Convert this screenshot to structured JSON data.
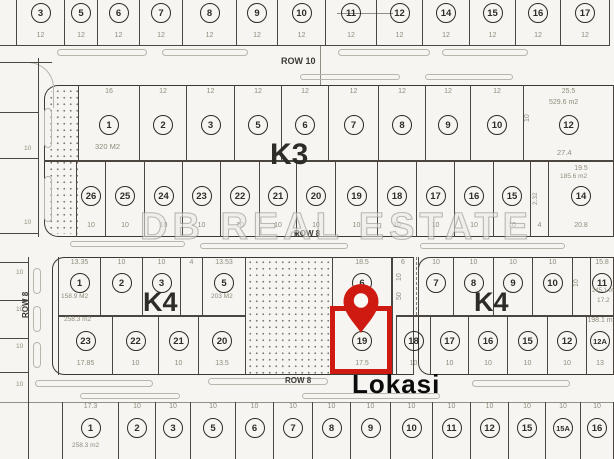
{
  "title": "site plan map",
  "location_label": "Lokasi",
  "watermark_text": "DB REAL ESTATE",
  "colors": {
    "paper": "#f6f5f1",
    "line": "#4b4740",
    "dimension": "#8f8b7c",
    "marker_red": "#cf1a12"
  },
  "strips": [
    {
      "name": "top-row-lots",
      "y": 0,
      "h": 46,
      "c": 3,
      "bY": 32,
      "cells": [
        {
          "x1": 16,
          "x2": 64,
          "n": "3",
          "b": "12"
        },
        {
          "x1": 64,
          "x2": 97,
          "n": "5",
          "b": "12"
        },
        {
          "x1": 97,
          "x2": 139,
          "n": "6",
          "b": "12"
        },
        {
          "x1": 139,
          "x2": 182,
          "n": "7",
          "b": "12"
        },
        {
          "x1": 182,
          "x2": 236,
          "n": "8",
          "b": "12"
        },
        {
          "x1": 236,
          "x2": 277,
          "n": "9",
          "b": "12"
        },
        {
          "x1": 277,
          "x2": 325,
          "n": "10",
          "b": "12"
        },
        {
          "x1": 325,
          "x2": 376,
          "n": "11",
          "b": "12"
        },
        {
          "x1": 376,
          "x2": 422,
          "n": "12",
          "b": "12"
        },
        {
          "x1": 422,
          "x2": 469,
          "n": "14",
          "b": "12"
        },
        {
          "x1": 469,
          "x2": 515,
          "n": "15",
          "b": "12"
        },
        {
          "x1": 515,
          "x2": 560,
          "n": "16",
          "b": "12"
        },
        {
          "x1": 560,
          "x2": 610,
          "n": "17",
          "b": "12"
        }
      ]
    },
    {
      "name": "k3-top-row",
      "y": 85,
      "h": 75,
      "c": 30,
      "tY": 3,
      "cells": [
        {
          "x1": 78,
          "x2": 139,
          "n": "1",
          "t": "16"
        },
        {
          "x1": 139,
          "x2": 186,
          "n": "2",
          "t": "12"
        },
        {
          "x1": 186,
          "x2": 234,
          "n": "3",
          "t": "12"
        },
        {
          "x1": 234,
          "x2": 281,
          "n": "5",
          "t": "12"
        },
        {
          "x1": 281,
          "x2": 328,
          "n": "6",
          "t": "12"
        },
        {
          "x1": 328,
          "x2": 378,
          "n": "7",
          "t": "12"
        },
        {
          "x1": 378,
          "x2": 425,
          "n": "8",
          "t": "12"
        },
        {
          "x1": 425,
          "x2": 470,
          "n": "9",
          "t": "12"
        },
        {
          "x1": 470,
          "x2": 523,
          "n": "10",
          "t": "12"
        },
        {
          "x1": 523,
          "x2": 614,
          "n": "12",
          "t": "25.5"
        }
      ]
    },
    {
      "name": "k3-bottom-row",
      "y": 162,
      "h": 75,
      "c": 24,
      "bY": 60,
      "tY": 3,
      "cells": [
        {
          "x1": 76,
          "x2": 105,
          "n": "26",
          "b": "10"
        },
        {
          "x1": 105,
          "x2": 144,
          "n": "25",
          "b": "10"
        },
        {
          "x1": 144,
          "x2": 182,
          "n": "24",
          "b": "10"
        },
        {
          "x1": 182,
          "x2": 220,
          "n": "23",
          "b": "10"
        },
        {
          "x1": 220,
          "x2": 259,
          "n": "22",
          "b": "10"
        },
        {
          "x1": 259,
          "x2": 296,
          "n": "21",
          "b": "10"
        },
        {
          "x1": 296,
          "x2": 335,
          "n": "20",
          "b": "10"
        },
        {
          "x1": 335,
          "x2": 377,
          "n": "19",
          "b": "10"
        },
        {
          "x1": 377,
          "x2": 416,
          "n": "18",
          "b": "10"
        },
        {
          "x1": 416,
          "x2": 454,
          "n": "17",
          "b": "10"
        },
        {
          "x1": 454,
          "x2": 493,
          "n": "16",
          "b": "10"
        },
        {
          "x1": 493,
          "x2": 530,
          "n": "15",
          "b": "10"
        },
        {
          "x1": 530,
          "x2": 548,
          "b": "4"
        },
        {
          "x1": 548,
          "x2": 614,
          "n": "14",
          "t": "19.5",
          "b": "20.8"
        }
      ]
    },
    {
      "name": "k4-left-top-row",
      "y": 257,
      "h": 58,
      "c": 16,
      "tY": 2,
      "cells": [
        {
          "x1": 58,
          "x2": 100,
          "n": "1",
          "t": "13.35"
        },
        {
          "x1": 100,
          "x2": 142,
          "n": "2",
          "t": "10"
        },
        {
          "x1": 142,
          "x2": 180,
          "n": "3",
          "t": "10"
        },
        {
          "x1": 180,
          "x2": 202,
          "t": "4"
        },
        {
          "x1": 202,
          "x2": 246,
          "n": "5",
          "t": "13.53"
        }
      ]
    },
    {
      "name": "k4-left-bottom-row",
      "y": 315,
      "h": 60,
      "c": 16,
      "bY": 45,
      "cells": [
        {
          "x1": 58,
          "x2": 112,
          "n": "23",
          "b": "17.85"
        },
        {
          "x1": 112,
          "x2": 158,
          "n": "22",
          "b": "10"
        },
        {
          "x1": 158,
          "x2": 198,
          "n": "21",
          "b": "10"
        },
        {
          "x1": 198,
          "x2": 246,
          "n": "20",
          "b": "13.5"
        }
      ]
    },
    {
      "name": "k4-lot6",
      "y": 257,
      "h": 58,
      "c": 16,
      "tY": 2,
      "cells": [
        {
          "x1": 332,
          "x2": 392,
          "n": "6",
          "t": "18.5"
        }
      ]
    },
    {
      "name": "k4-narrow-lot",
      "y": 257,
      "h": 118,
      "tY": 2,
      "cells": [
        {
          "x1": 392,
          "x2": 414,
          "t": "6"
        }
      ]
    },
    {
      "name": "k4-lot19-highlighted",
      "y": 315,
      "h": 60,
      "c": 16,
      "bY": 45,
      "cells": [
        {
          "x1": 332,
          "x2": 392,
          "n": "19",
          "b": "17.5"
        }
      ]
    },
    {
      "name": "k4-right-top-row",
      "y": 257,
      "h": 58,
      "c": 16,
      "tY": 2,
      "cells": [
        {
          "x1": 418,
          "x2": 453,
          "n": "7",
          "t": "10"
        },
        {
          "x1": 453,
          "x2": 493,
          "n": "8",
          "t": "10"
        },
        {
          "x1": 493,
          "x2": 532,
          "n": "9",
          "t": "10"
        },
        {
          "x1": 532,
          "x2": 572,
          "n": "10",
          "t": "10"
        },
        {
          "x1": 572,
          "x2": 590
        },
        {
          "x1": 590,
          "x2": 614,
          "n": "11",
          "t": "15.8"
        }
      ]
    },
    {
      "name": "k4-right-bottom-row",
      "y": 315,
      "h": 60,
      "c": 16,
      "bY": 45,
      "tY": 2,
      "cells": [
        {
          "x1": 396,
          "x2": 430,
          "n": "18",
          "b": "10"
        },
        {
          "x1": 430,
          "x2": 468,
          "n": "17",
          "b": "10"
        },
        {
          "x1": 468,
          "x2": 507,
          "n": "16",
          "b": "10"
        },
        {
          "x1": 507,
          "x2": 547,
          "n": "15",
          "b": "10"
        },
        {
          "x1": 547,
          "x2": 586,
          "n": "12",
          "b": "10"
        },
        {
          "x1": 586,
          "x2": 614,
          "n": "12A",
          "t": "198.1 m",
          "b": "13"
        }
      ]
    },
    {
      "name": "bottom-row-lots",
      "y": 402,
      "h": 57,
      "c": 16,
      "tY": 1,
      "cells": [
        {
          "x1": 28,
          "x2": 62
        },
        {
          "x1": 62,
          "x2": 118,
          "n": "1",
          "t": "17.3"
        },
        {
          "x1": 118,
          "x2": 155,
          "n": "2",
          "t": "10"
        },
        {
          "x1": 155,
          "x2": 190,
          "n": "3",
          "t": "10"
        },
        {
          "x1": 190,
          "x2": 235,
          "n": "5",
          "t": "10"
        },
        {
          "x1": 235,
          "x2": 273,
          "n": "6",
          "t": "10"
        },
        {
          "x1": 273,
          "x2": 312,
          "n": "7",
          "t": "10"
        },
        {
          "x1": 312,
          "x2": 350,
          "n": "8",
          "t": "10"
        },
        {
          "x1": 350,
          "x2": 390,
          "n": "9",
          "t": "10"
        },
        {
          "x1": 390,
          "x2": 432,
          "n": "10",
          "t": "10"
        },
        {
          "x1": 432,
          "x2": 470,
          "n": "11",
          "t": "10"
        },
        {
          "x1": 470,
          "x2": 508,
          "n": "12",
          "t": "10"
        },
        {
          "x1": 508,
          "x2": 545,
          "n": "15",
          "t": "10"
        },
        {
          "x1": 545,
          "x2": 580,
          "n": "15A",
          "t": "10"
        },
        {
          "x1": 580,
          "x2": 614,
          "n": "16",
          "t": "10"
        }
      ]
    }
  ],
  "boxes": [
    {
      "name": "block-k3-outline",
      "x": 44,
      "y": 85,
      "w": 572,
      "h": 152,
      "r": "14px 0 0 14px",
      "sides": "tlb"
    },
    {
      "name": "block-k4-left-outline",
      "x": 52,
      "y": 257,
      "w": 362,
      "h": 118,
      "r": "12px 0 0 12px",
      "sides": "tlb"
    },
    {
      "name": "block-k4-right-outline",
      "x": 418,
      "y": 257,
      "w": 198,
      "h": 118,
      "r": "12px 0 0 12px",
      "sides": "tlb"
    },
    {
      "name": "road-corner-curb",
      "x": 14,
      "y": 62,
      "w": 40,
      "h": 46,
      "r": "0 26px 0 0",
      "sides": "tr",
      "light": true
    }
  ],
  "lines": [
    {
      "x": 0,
      "y": 45,
      "w": 610,
      "h": 1
    },
    {
      "x": 0,
      "y": 62,
      "w": 52,
      "h": 1
    },
    {
      "x": 320,
      "y": 46,
      "w": 1,
      "h": 39,
      "light": true
    },
    {
      "x": 337,
      "y": 13,
      "w": 56,
      "h": 1,
      "light": true
    },
    {
      "x": 44,
      "y": 160,
      "w": 570,
      "h": 1.5
    },
    {
      "x": 58,
      "y": 315,
      "w": 188,
      "h": 1.5
    },
    {
      "x": 396,
      "y": 315,
      "w": 218,
      "h": 1.5
    },
    {
      "x": 416,
      "y": 257,
      "w": 1,
      "h": 58,
      "dashed": true
    },
    {
      "x": 38,
      "y": 58,
      "w": 1,
      "h": 179
    },
    {
      "x": 0,
      "y": 112,
      "w": 38,
      "h": 1
    },
    {
      "x": 0,
      "y": 158,
      "w": 38,
      "h": 1
    },
    {
      "x": 0,
      "y": 233,
      "w": 38,
      "h": 1
    },
    {
      "x": 28,
      "y": 257,
      "w": 1,
      "h": 202
    },
    {
      "x": 0,
      "y": 262,
      "w": 28,
      "h": 1
    },
    {
      "x": 0,
      "y": 300,
      "w": 28,
      "h": 1
    },
    {
      "x": 0,
      "y": 338,
      "w": 28,
      "h": 1
    },
    {
      "x": 0,
      "y": 372,
      "w": 28,
      "h": 1
    },
    {
      "x": 0,
      "y": 402,
      "w": 614,
      "h": 1,
      "light": true
    }
  ],
  "bars": [
    {
      "x": 57,
      "y": 49,
      "w": 90,
      "h": 7
    },
    {
      "x": 162,
      "y": 49,
      "w": 86,
      "h": 7
    },
    {
      "x": 338,
      "y": 49,
      "w": 92,
      "h": 7
    },
    {
      "x": 442,
      "y": 49,
      "w": 86,
      "h": 7
    },
    {
      "x": 300,
      "y": 74,
      "w": 100,
      "h": 6
    },
    {
      "x": 425,
      "y": 74,
      "w": 88,
      "h": 6
    },
    {
      "x": 70,
      "y": 241,
      "w": 115,
      "h": 6
    },
    {
      "x": 200,
      "y": 243,
      "w": 148,
      "h": 6
    },
    {
      "x": 420,
      "y": 243,
      "w": 145,
      "h": 6
    },
    {
      "x": 35,
      "y": 380,
      "w": 118,
      "h": 7
    },
    {
      "x": 208,
      "y": 378,
      "w": 120,
      "h": 7
    },
    {
      "x": 472,
      "y": 380,
      "w": 98,
      "h": 7
    },
    {
      "x": 302,
      "y": 393,
      "w": 138,
      "h": 6
    },
    {
      "x": 80,
      "y": 393,
      "w": 100,
      "h": 6
    },
    {
      "x": 33,
      "y": 268,
      "w": 8,
      "h": 26
    },
    {
      "x": 33,
      "y": 306,
      "w": 8,
      "h": 26
    },
    {
      "x": 33,
      "y": 342,
      "w": 8,
      "h": 26
    },
    {
      "x": 44,
      "y": 108,
      "w": 8,
      "h": 40
    },
    {
      "x": 44,
      "y": 176,
      "w": 8,
      "h": 46
    }
  ],
  "dots": [
    {
      "name": "hatched-strip-k3",
      "x": 48,
      "y": 88,
      "w": 30,
      "h": 146,
      "r": "12px 0 0 0"
    },
    {
      "name": "hatched-lot-k4",
      "x": 247,
      "y": 259,
      "w": 85,
      "h": 115,
      "r": "0"
    }
  ],
  "labels": [
    {
      "name": "row-10-label",
      "t": "ROW 10",
      "x": 281,
      "y": 57,
      "s": 9,
      "cls": "bold"
    },
    {
      "name": "row-8-mid-label",
      "t": "ROW 8",
      "x": 294,
      "y": 230,
      "s": 8,
      "cls": "bold"
    },
    {
      "name": "row-8-bottom-label",
      "t": "ROW 8",
      "x": 285,
      "y": 377,
      "s": 8,
      "cls": "bold"
    },
    {
      "name": "row-8-left-label",
      "t": "ROW 8",
      "x": 22,
      "y": 318,
      "s": 8,
      "cls": "bold rot"
    },
    {
      "name": "block-k3-label",
      "t": "K3",
      "x": 270,
      "y": 140,
      "s": 30,
      "cls": "ink"
    },
    {
      "name": "block-k4-left-label",
      "t": "K4",
      "x": 143,
      "y": 289,
      "s": 27,
      "cls": "ink"
    },
    {
      "name": "block-k4-right-label",
      "t": "K4",
      "x": 474,
      "y": 289,
      "s": 27,
      "cls": "ink"
    },
    {
      "name": "location-label",
      "t": "Lokasi",
      "x": 352,
      "y": 371,
      "s": 26,
      "cls": "black"
    },
    {
      "name": "area-label",
      "t": "320 M2",
      "x": 95,
      "y": 143,
      "s": 7.5
    },
    {
      "name": "area-label",
      "t": "529.6 m2",
      "x": 549,
      "y": 99,
      "s": 7
    },
    {
      "name": "dimension-label",
      "t": "27.4",
      "x": 557,
      "y": 149,
      "s": 7.5
    },
    {
      "name": "dimension-label",
      "t": "10",
      "x": 524,
      "y": 122,
      "s": 7,
      "cls": "rot"
    },
    {
      "name": "area-label",
      "t": "185.6 m2",
      "x": 560,
      "y": 174,
      "s": 6.5
    },
    {
      "name": "dimension-label",
      "t": "2.32",
      "x": 533,
      "y": 205,
      "s": 6.5,
      "cls": "rot"
    },
    {
      "name": "area-label",
      "t": "158.9 M2",
      "x": 61,
      "y": 294,
      "s": 6.5
    },
    {
      "name": "area-label",
      "t": "203 M2",
      "x": 211,
      "y": 294,
      "s": 6.5
    },
    {
      "name": "area-label",
      "t": "258.3 m2",
      "x": 64,
      "y": 317,
      "s": 6.5
    },
    {
      "name": "dimension-label",
      "t": "10",
      "x": 396,
      "y": 281,
      "s": 7,
      "cls": "rot"
    },
    {
      "name": "dimension-label",
      "t": "50",
      "x": 396,
      "y": 300,
      "s": 7,
      "cls": "rot"
    },
    {
      "name": "area-label",
      "t": "245.1 m2",
      "x": 592,
      "y": 288,
      "s": 6
    },
    {
      "name": "dimension-label",
      "t": "17.2",
      "x": 597,
      "y": 298,
      "s": 6.5
    },
    {
      "name": "dimension-label",
      "t": "10",
      "x": 573,
      "y": 287,
      "s": 7,
      "cls": "rot"
    },
    {
      "name": "area-label",
      "t": "258.3 m2",
      "x": 72,
      "y": 443,
      "s": 6.5
    },
    {
      "name": "dimension-label",
      "t": "10",
      "x": 16,
      "y": 270,
      "s": 6.5
    },
    {
      "name": "dimension-label",
      "t": "10",
      "x": 16,
      "y": 307,
      "s": 6.5
    },
    {
      "name": "dimension-label",
      "t": "10",
      "x": 16,
      "y": 344,
      "s": 6.5
    },
    {
      "name": "dimension-label",
      "t": "10",
      "x": 16,
      "y": 382,
      "s": 6.5
    },
    {
      "name": "dimension-label",
      "t": "10",
      "x": 24,
      "y": 146,
      "s": 6.5
    },
    {
      "name": "dimension-label",
      "t": "10",
      "x": 24,
      "y": 220,
      "s": 6.5
    }
  ],
  "marker": {
    "box": {
      "x": 330,
      "y": 306,
      "w": 62,
      "h": 68
    },
    "pin": {
      "x": 338,
      "y": 280,
      "w": 46,
      "h": 56
    }
  }
}
